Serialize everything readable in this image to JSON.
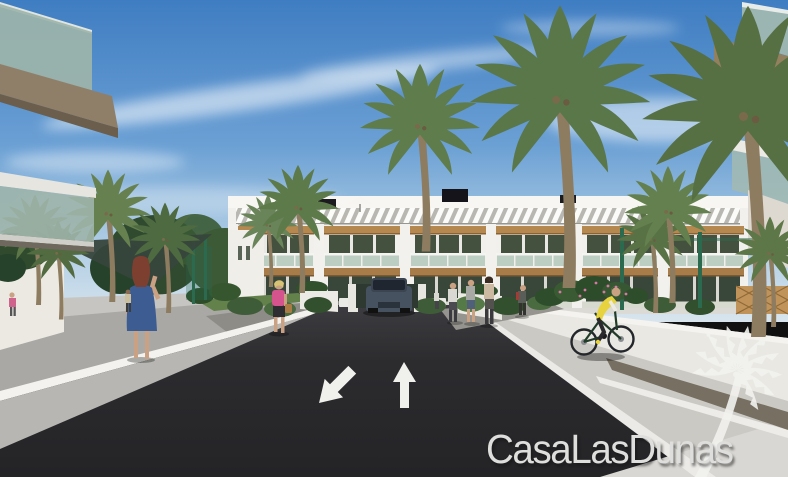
{
  "scene": {
    "type": "architectural-render-photo",
    "description": "Street-level 3D rendering of a white two-storey apartment development with timber pergolas, palm trees, asphalt access road with direction arrows and zebra crossing, pedestrians and a cyclist",
    "watermark": {
      "brand": "CasaLasDunas",
      "logo": "palm-tree-icon"
    },
    "road_markings": {
      "arrow_left_lane": "toward-viewer",
      "arrow_right_lane": "away-from-viewer",
      "crosswalk": "zebra"
    },
    "palette": {
      "sky_top": "#3f7dc2",
      "sky_horizon": "#d8e5ee",
      "cloud": "#ffffff",
      "asphalt": "#2c2c2f",
      "road_marking_white": "#f0f0ec",
      "kerb_wall": "#e9e8e2",
      "ramp_grey": "#a9a8a4",
      "pavement": "#cbc9c4",
      "paver_band": "#766f62",
      "facade_white": "#f1f0ec",
      "wood_trim": "#b5884f",
      "window_glass": "#44513f",
      "balcony_glass": "#a9c2b4",
      "palm_green": "#5f7c4c",
      "tree_green": "#3a5a34",
      "fence_green": "#2b6a4e",
      "dress_blue": "#3d5c92",
      "top_pink": "#d5548e",
      "vest_yellow": "#e6d33d",
      "car_body": "#46525f",
      "watermark_white": "#f2f2ef"
    }
  }
}
